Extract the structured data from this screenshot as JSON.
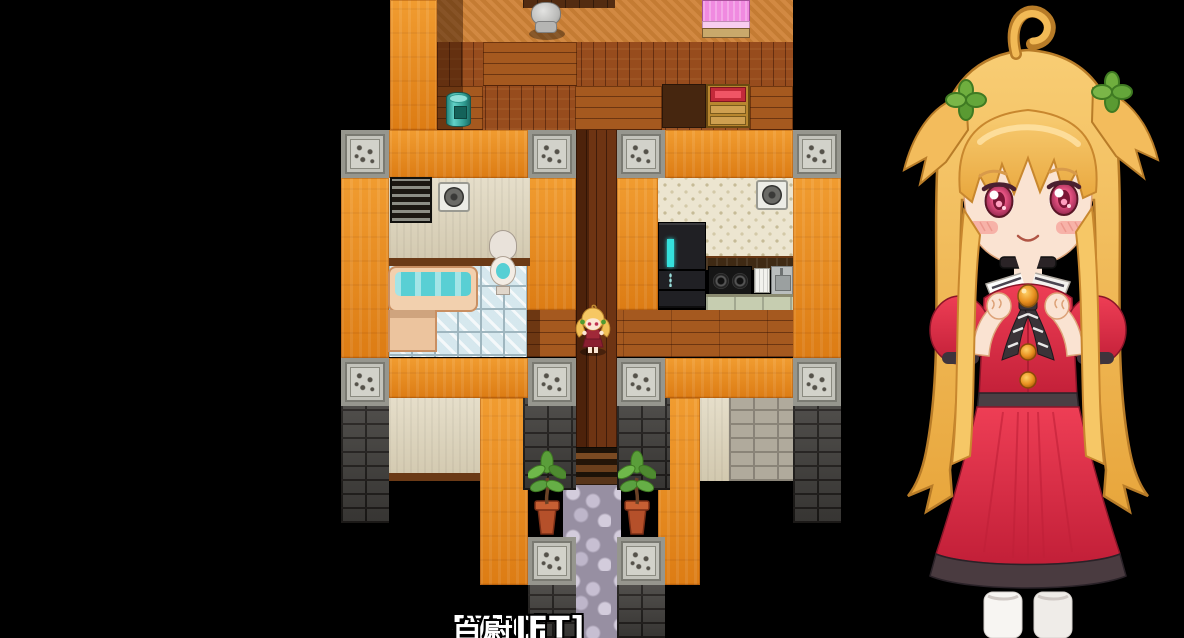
{
  "hud": {
    "hotkeys": [
      {
        "key": "[ESC]",
        "label": "狀態"
      },
      {
        "key": "[SHIFT]",
        "label": "緩速"
      },
      {
        "key": "[V]",
        "label": "自慰"
      }
    ]
  },
  "map": {
    "rooms": [
      "bedroom",
      "bathroom",
      "corridor",
      "kitchen",
      "entrance"
    ],
    "objects": [
      "office-chair",
      "bed",
      "trash-barrel",
      "drawer-chest",
      "ventilation-grille",
      "wall-fan",
      "bathtub",
      "toilet",
      "refrigerator",
      "stove",
      "dish-rack",
      "kitchen-sink",
      "stone-pillar",
      "potted-plant",
      "stone-steps",
      "cobblestone-path"
    ]
  },
  "player": {
    "sprite": "blonde-twintail-girl"
  },
  "portrait": {
    "description": "smiling blonde girl with twin side tufts, green clover hair clips, black choker, white collar and red dress, fists raised"
  },
  "colors": {
    "background": "#000000",
    "wall_orange": "#ec8a18",
    "wood_floor": "#a5591f",
    "water_teal": "#59cfd4",
    "dress_red": "#e23349",
    "hair_blonde": "#f3bc5c",
    "hint_text": "#ffffff"
  }
}
